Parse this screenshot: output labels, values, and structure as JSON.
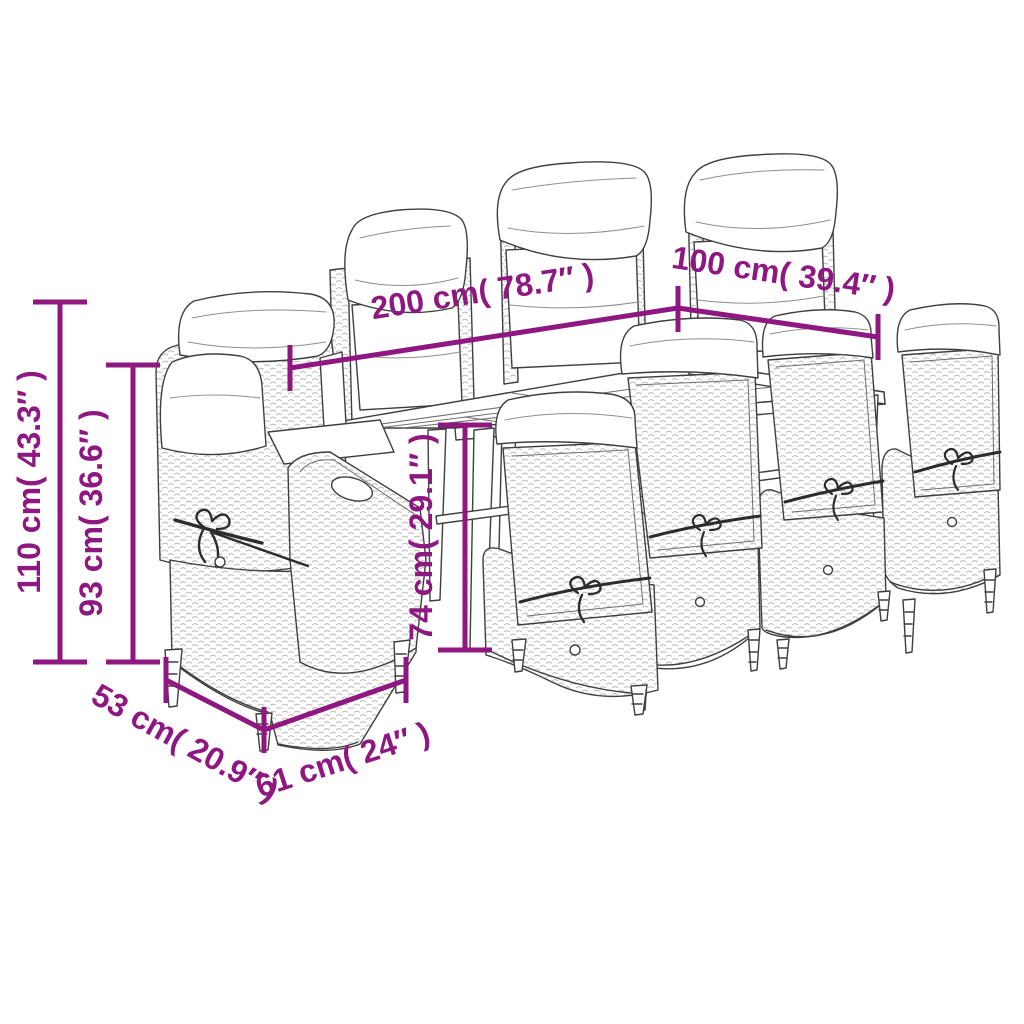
{
  "diagram": {
    "subject": "outdoor dining furniture set line drawing with dimension annotations",
    "colors": {
      "accent": "#8F1782",
      "line_art": "#3F3F3F",
      "background": "#FFFFFF"
    },
    "labels": {
      "table_length": "200 cm( 78.7″ )",
      "table_width": "100 cm( 39.4″ )",
      "chair_total_height": "110 cm( 43.3″ )",
      "chair_back_height": "93 cm( 36.6″ )",
      "table_height": "74 cm( 29.1″ )",
      "chair_depth": "53 cm( 20.9″ )",
      "chair_width": "61 cm( 24″ )"
    }
  }
}
